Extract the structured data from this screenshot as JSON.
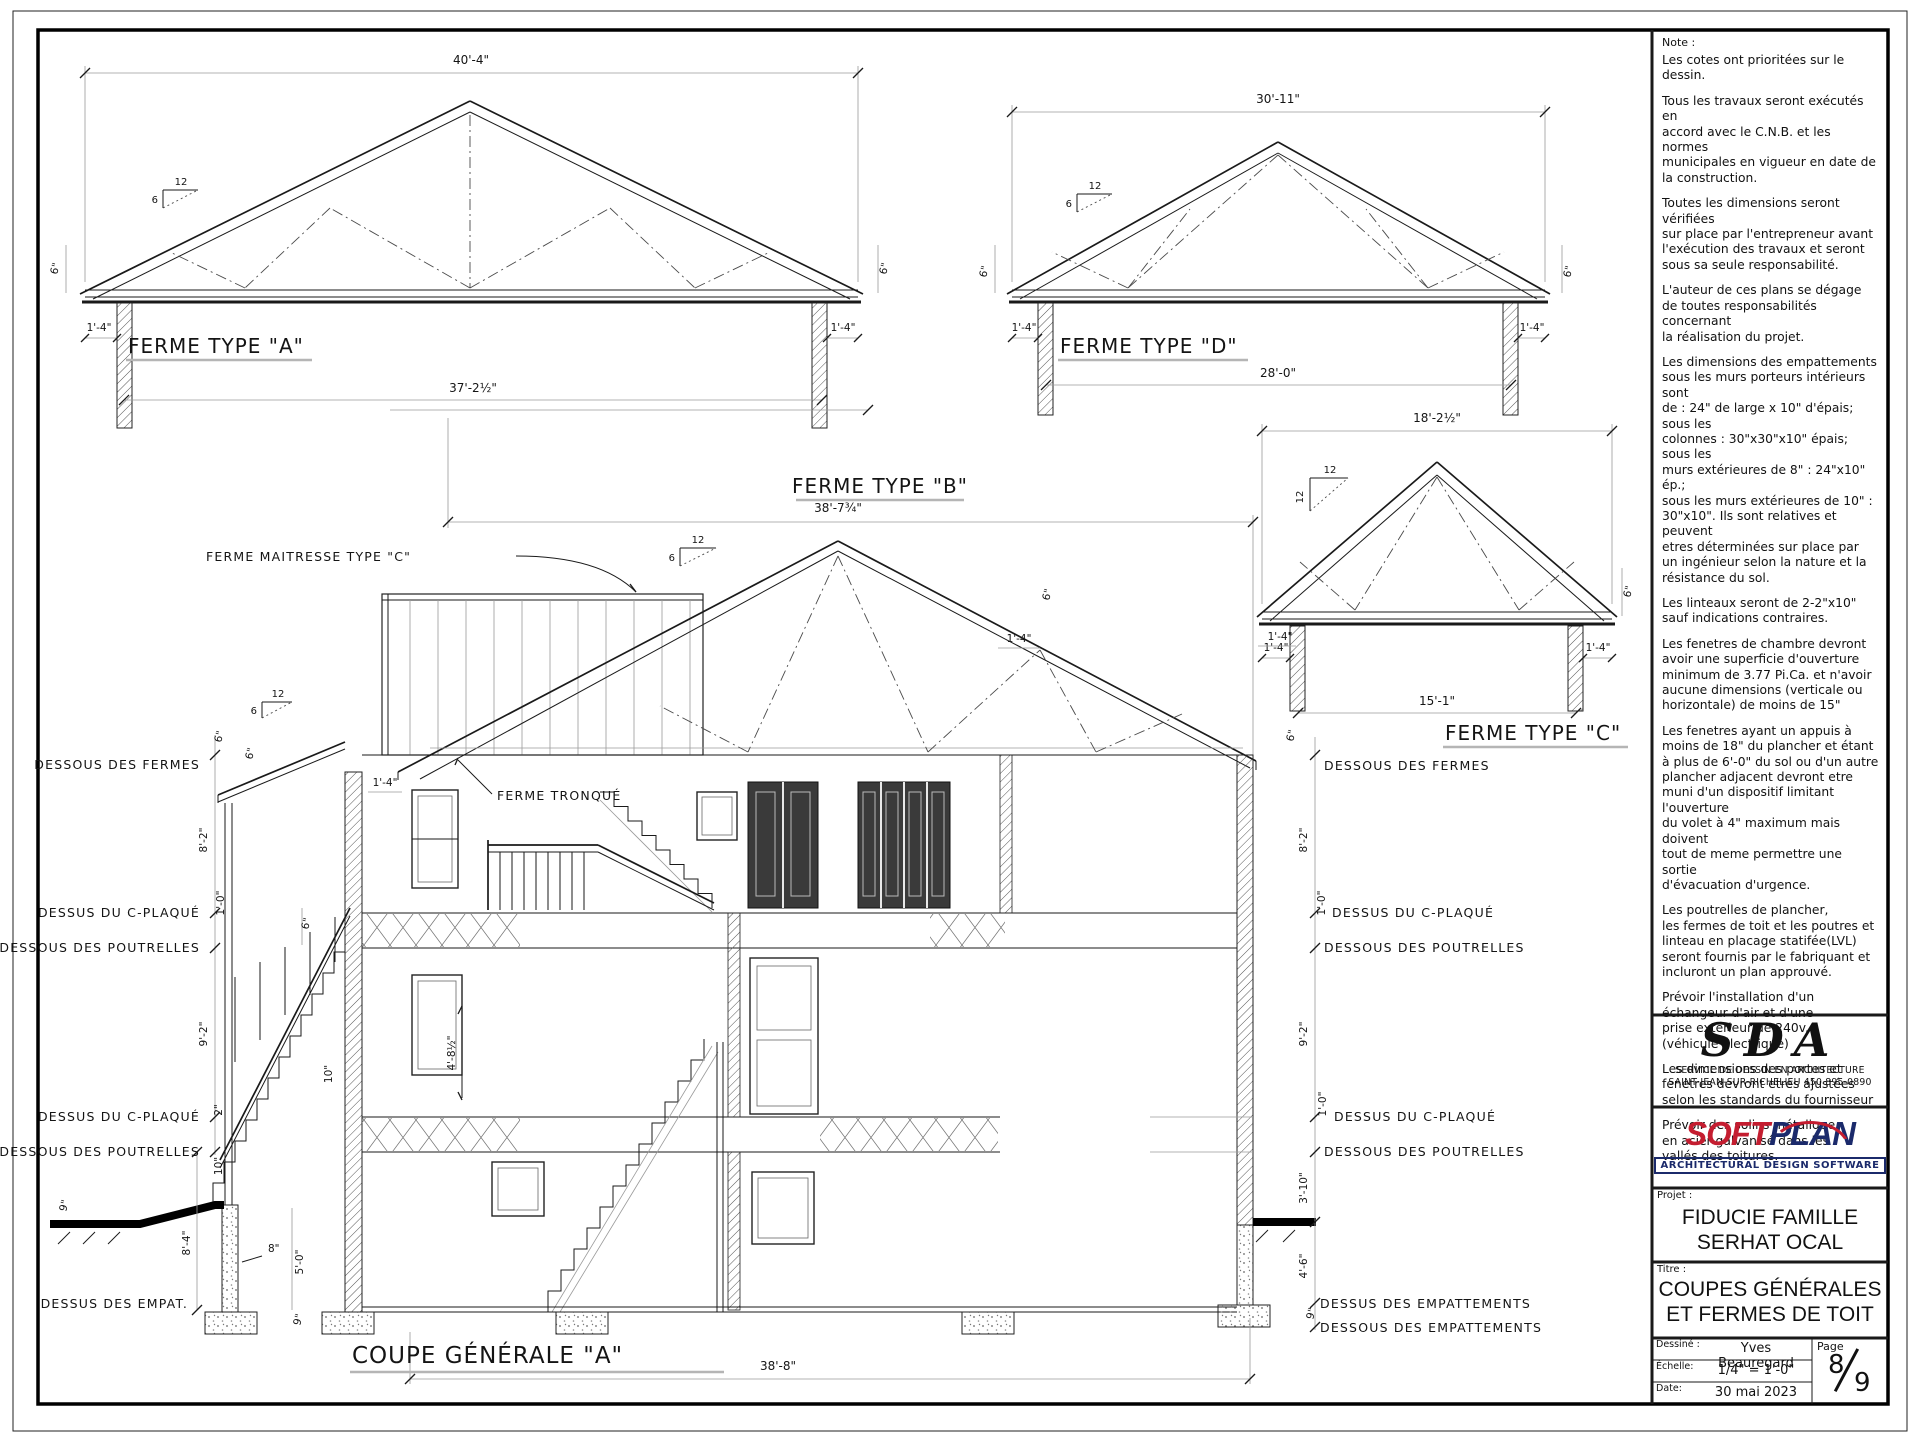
{
  "notes": {
    "heading": "Note :",
    "paragraphs": [
      "Les cotes ont prioritées sur le dessin.",
      "Tous les travaux seront exécutés en\naccord avec le C.N.B. et les normes\nmunicipales en vigueur en date de\nla construction.",
      "Toutes les dimensions seront vérifiées\nsur place par l'entrepreneur avant\nl'exécution des travaux et seront\nsous sa seule responsabilité.",
      "L'auteur de ces plans se dégage\nde toutes responsabilités concernant\nla réalisation du projet.",
      "Les dimensions des empattements\nsous les murs porteurs intérieurs sont\nde : 24\" de large x 10\" d'épais; sous les\ncolonnes : 30\"x30\"x10\" épais; sous les\nmurs extérieures de 8\" : 24\"x10\" ép.;\nsous les murs extérieures de 10\" :\n30\"x10\". Ils sont relatives et peuvent\netres déterminées sur place par\nun ingénieur selon la nature et la\nrésistance du sol.",
      "Les linteaux seront de 2-2\"x10\"\nsauf indications contraires.",
      "Les fenetres de chambre devront\navoir une superficie d'ouverture\nminimum de 3.77 Pi.Ca. et n'avoir\naucune dimensions (verticale ou\nhorizontale) de moins de 15\"",
      "Les fenetres ayant un appuis à\nmoins de 18\" du plancher et étant\nà plus de 6'-0\" du sol ou d'un autre\nplancher adjacent devront etre\nmuni d'un dispositif limitant l'ouverture\ndu volet à  4\"  maximum mais doivent\ntout de meme permettre une sortie\nd'évacuation d'urgence.",
      "Les poutrelles de plancher,\nles fermes de toit et les poutres et\nlinteau en placage statifée(LVL)\nseront fournis par le fabriquant et\nincluront un plan approuvé.",
      "Prévoir l'installation d'un\néchangeur d'air et d'une\nprise extérieur de 240v.\n(véhicule électrique)",
      "Les dimensions des portes et\nfenetres devront etres ajustées\nselon les standards du fournisseur",
      "Prévoir des solins métalique\nen acier galvanisé dans les\nvallés des toitures."
    ]
  },
  "title_block": {
    "sda": {
      "logo": "SDA",
      "line1": "SERVICE DE DESSIN EN ARCHITECTURE",
      "line2": "SAINT-JEAN-SUR-RICHELIEU  450 895-0890"
    },
    "softplan": {
      "part1": "SOFT",
      "part2": "PLAN",
      "tagline": "ARCHITECTURAL DESIGN SOFTWARE",
      "red": "#c41d30",
      "blue": "#1b2a6b"
    },
    "project": {
      "label": "Projet :",
      "line1": "FIDUCIE FAMILLE",
      "line2": "SERHAT OCAL"
    },
    "title": {
      "label": "Titre :",
      "line1": "COUPES GÉNÉRALES",
      "line2": "ET FERMES DE TOIT"
    },
    "drawn": {
      "label": "Dessiné :",
      "value": "Yves Beauregard"
    },
    "scale": {
      "label": "Échelle:",
      "value": "1/4\" = 1'-0\""
    },
    "date": {
      "label": "Date:",
      "value": "30 mai 2023"
    },
    "page": {
      "label": "Page",
      "numerator": "8",
      "denominator": "9"
    }
  },
  "trusses": {
    "a": {
      "label": "FERME TYPE \"A\"",
      "top_dim": "40'-4\"",
      "bottom_dim": "37'-2½\"",
      "overhang_left": "1'-4\"",
      "overhang_right": "1'-4\"",
      "heel_left": "6\"",
      "heel_right": "6\"",
      "slope_run": "12",
      "slope_rise": "6"
    },
    "d": {
      "label": "FERME TYPE \"D\"",
      "top_dim": "30'-11\"",
      "bottom_dim": "28'-0\"",
      "overhang_left": "1'-4\"",
      "overhang_right": "1'-4\"",
      "heel_left": "6\"",
      "heel_right": "6\"",
      "slope_run": "12",
      "slope_rise": "6"
    },
    "c": {
      "label": "FERME TYPE \"C\"",
      "top_dim": "18'-2½\"",
      "bottom_dim": "15'-1\"",
      "overhang_left": "1'-4\"",
      "overhang_right": "1'-4\"",
      "heel_right": "6\"",
      "slope_run": "12",
      "slope_rise": "12"
    },
    "b": {
      "label": "FERME TYPE \"B\"",
      "top_dim": "38'-7¾\"",
      "slope_run": "12",
      "slope_rise": "6",
      "heel": "6\"",
      "overhang": "1'-4\"",
      "callout_maitresse": "FERME MAITRESSE TYPE \"C\"",
      "callout_tronque": "FERME TRONQUÉ"
    }
  },
  "section": {
    "title": "COUPE GÉNÉRALE \"A\"",
    "bottom_dim": "38'-8\"",
    "left_labels": [
      "DESSOUS DES FERMES",
      "DESSUS DU C-PLAQUÉ",
      "DESSOUS DES POUTRELLES",
      "DESSUS DU C-PLAQUÉ",
      "DESSOUS DES POUTRELLES",
      "DESSUS DES EMPAT."
    ],
    "right_labels": [
      "DESSOUS DES FERMES",
      "DESSUS DU C-PLAQUÉ",
      "DESSOUS DES POUTRELLES",
      "DESSUS DU C-PLAQUÉ",
      "DESSOUS DES POUTRELLES",
      "DESSUS DES EMPATTEMENTS",
      "DESSOUS DES EMPATTEMENTS"
    ],
    "left_dims": {
      "heel": "6\"",
      "storey2": "8'-2\"",
      "floor1": "1'-0\"",
      "storey1": "9'-2\"",
      "floor2_top": "2\"",
      "floor2_depth": "10\"",
      "grade": "9\"",
      "foundation": "8'-4\"",
      "porch_wall": "8\"",
      "porch_found": "5'-0\"",
      "footing": "9\"",
      "bsmt_wall": "10\"",
      "stair": "4'-8½\"",
      "porch_heel": "6\"",
      "porch_heel2": "6\"",
      "overhang": "1'-4\""
    },
    "right_dims": {
      "heel": "6\"",
      "overhang": "1'-4\"",
      "storey2": "8'-2\"",
      "floor1": "1'-0\"",
      "storey1": "9'-2\"",
      "floor2": "1'-0\"",
      "grade": "3'-10\"",
      "foundation": "4'-6\"",
      "footing": "9\""
    },
    "porch_slope": {
      "run": "12",
      "rise": "6"
    }
  }
}
